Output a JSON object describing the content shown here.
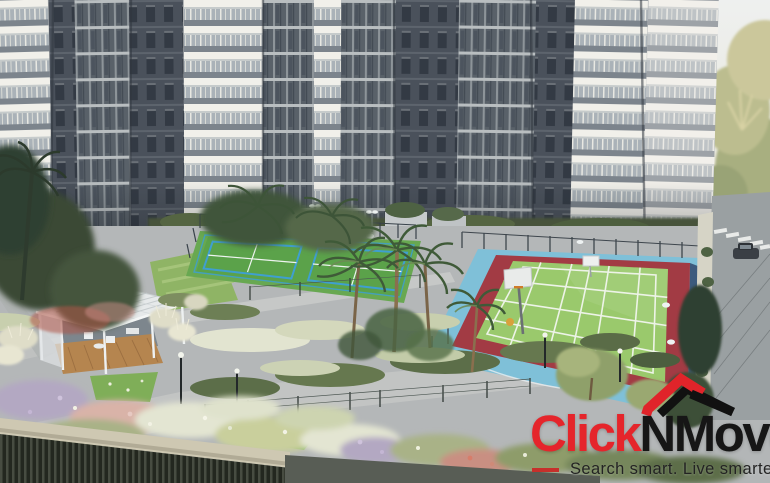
{
  "image": {
    "kind": "real-estate aerial render",
    "subject": "apartment complex podium with sports courts, gazebo and gardens"
  },
  "logo": {
    "brand_primary": "Click",
    "brand_secondary": "NMove",
    "tagline": "Search smart. Live smarter",
    "brand_primary_color": "#e5252b",
    "brand_secondary_color": "#161616",
    "tagline_color": "#232323",
    "roof_icon_red": "#e0242a",
    "roof_icon_black": "#111111"
  },
  "scene": {
    "elements": [
      "apartment-towers",
      "badminton-courts",
      "multi-sport-court",
      "basketball-hoop",
      "gazebo",
      "garden-paths",
      "flower-beds",
      "palm-trees",
      "road-with-crosswalk",
      "car"
    ],
    "colors": {
      "building_dark": "#4a515b",
      "building_white": "#f1f0ea",
      "court_green": "#9ac96c",
      "court_red_border": "#a23b44",
      "court_blue_apron": "#7fc0d8",
      "tennis_green": "#5ba24a",
      "tennis_blue_line": "#3f9fd0",
      "lawn_green": "#8fb465",
      "path_gray": "#bcbfbe",
      "deck_wall_beige": "#cec8b2",
      "wood_deck": "#b5854f",
      "sky": "#edefee"
    }
  }
}
